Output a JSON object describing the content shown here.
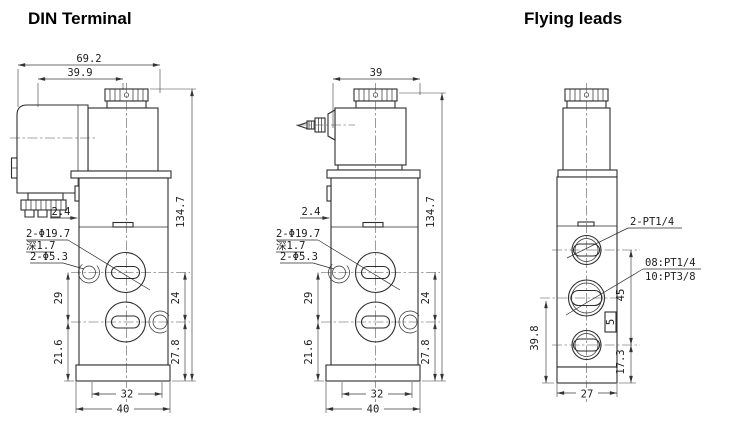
{
  "titles": {
    "din": "DIN Terminal",
    "flying": "Flying leads"
  },
  "din_view": {
    "dims": {
      "overall_width": "69.2",
      "coil_center_offset": "39.9",
      "side_tab": "2.4",
      "overall_height": "134.7",
      "left_upper": "29",
      "left_lower": "21.6",
      "right_upper": "24",
      "right_lower": "27.8",
      "slot_span": "32",
      "base_width": "40"
    },
    "labels": {
      "counterbore": "2-Φ19.7",
      "counterbore_depth": "深1.7",
      "mounting_holes": "2-Φ5.3"
    }
  },
  "lead_view": {
    "dims": {
      "coil_width": "39",
      "side_tab": "2.4",
      "overall_height": "134.7",
      "left_upper": "29",
      "left_lower": "21.6",
      "right_upper": "24",
      "right_lower": "27.8",
      "slot_span": "32",
      "base_width": "40"
    },
    "labels": {
      "counterbore": "2-Φ19.7",
      "counterbore_depth": "深1.7",
      "mounting_holes": "2-Φ5.3"
    }
  },
  "front_view": {
    "dims": {
      "mid_port_to_base": "39.8",
      "port_span": "45",
      "override_height": "5",
      "bottom_port_to_base": "17.3",
      "body_width": "27"
    },
    "labels": {
      "pilot_ports": "2-PT1/4",
      "main_port_08": "08:PT1/4",
      "main_port_10": "10:PT3/8"
    }
  }
}
